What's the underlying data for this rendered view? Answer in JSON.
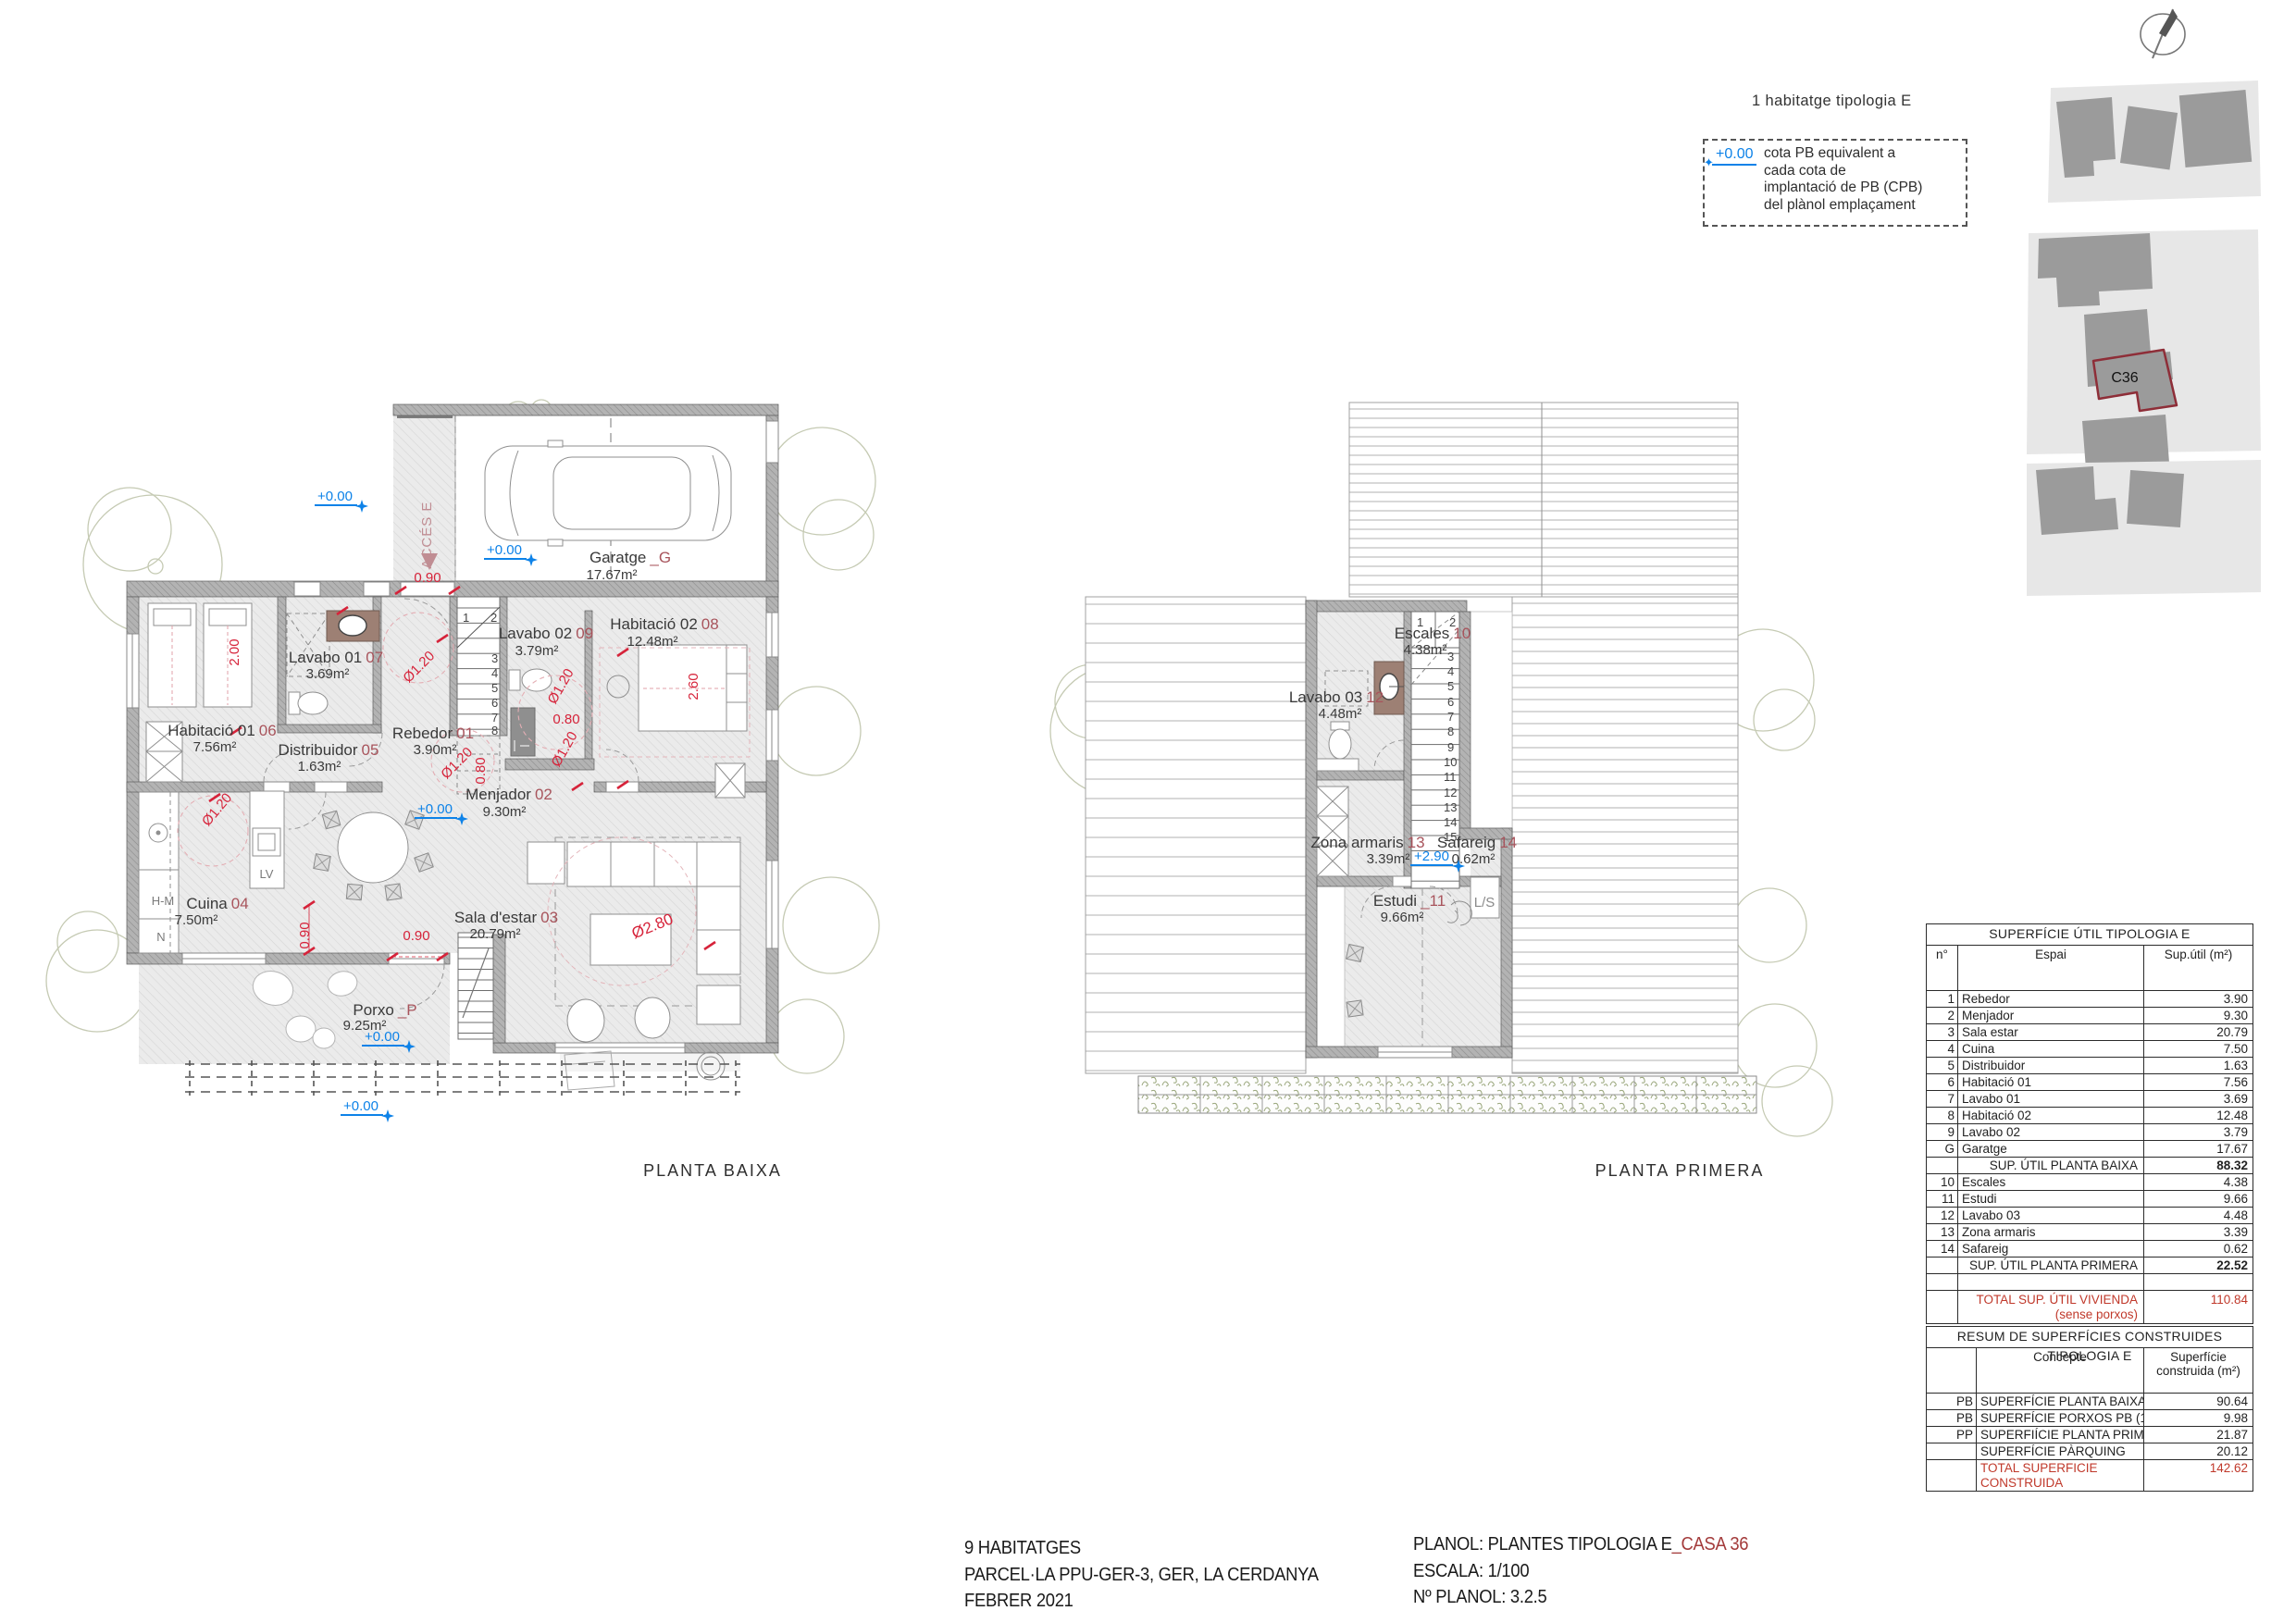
{
  "header": {
    "note": "1 habitatge tipologia E"
  },
  "legend": {
    "cota": "+0.00",
    "lines": [
      "cota PB equivalent a",
      "cada cota de",
      "implantació de PB (CPB)",
      "del plànol emplaçament"
    ]
  },
  "site_map": {
    "parcel_label": "C36"
  },
  "plans": {
    "pb": {
      "caption": "PLANTA BAIXA",
      "access_label": "ACCÉS E",
      "rooms": [
        {
          "name": "Garatge",
          "code": "_G",
          "area": "17.67m²"
        },
        {
          "name": "Lavabo 02",
          "code": "09",
          "area": "3.79m²"
        },
        {
          "name": "Habitació 02",
          "code": "08",
          "area": "12.48m²"
        },
        {
          "name": "Lavabo 01",
          "code": "07",
          "area": "3.69m²"
        },
        {
          "name": "Habitació 01",
          "code": "06",
          "area": "7.56m²"
        },
        {
          "name": "Distribuidor",
          "code": "05",
          "area": "1.63m²"
        },
        {
          "name": "Rebedor",
          "code": "01",
          "area": "3.90m²"
        },
        {
          "name": "Menjador",
          "code": "02",
          "area": "9.30m²"
        },
        {
          "name": "Cuina",
          "code": "04",
          "area": "7.50m²"
        },
        {
          "name": "Sala d'estar",
          "code": "03",
          "area": "20.79m²"
        },
        {
          "name": "Porxo",
          "code": "_P",
          "area": "9.25m²"
        }
      ],
      "dims": [
        "0.90",
        "2.00",
        "Ø1.20",
        "Ø1.20",
        "0.80",
        "Ø1.20",
        "Ø1.20",
        "0.80",
        "2.60",
        "Ø1.20",
        "0.90",
        "0.90",
        "Ø2.80"
      ],
      "cotas": [
        "+0.00",
        "+0.00",
        "+0.00",
        "+0.00",
        "+0.00"
      ],
      "appliances": {
        "lv": "LV",
        "hm": "H-M",
        "n": "N"
      },
      "stair_numbers": [
        "1",
        "2",
        "3",
        "4",
        "5",
        "6",
        "7",
        "8"
      ]
    },
    "pp": {
      "caption": "PLANTA PRIMERA",
      "cota": "+2.90",
      "ls": "L/S",
      "rooms": [
        {
          "name": "Escales",
          "code": "10",
          "area": "4.38m²"
        },
        {
          "name": "Lavabo 03",
          "code": "12",
          "area": "4.48m²"
        },
        {
          "name": "Zona armaris",
          "code": "13",
          "area": "3.39m²"
        },
        {
          "name": "Safareig",
          "code": "14",
          "area": "0.62m²"
        },
        {
          "name": "Estudi",
          "code": "_11",
          "area": "9.66m²"
        }
      ],
      "stair_numbers": [
        "1",
        "2",
        "3",
        "4",
        "5",
        "6",
        "7",
        "8",
        "9",
        "10",
        "11",
        "12",
        "13",
        "14",
        "15"
      ]
    }
  },
  "tables": {
    "util": {
      "title": "SUPERFÍCIE ÚTIL TIPOLOGIA E",
      "col_no": "n°",
      "col_espai": "Espai",
      "col_sup": "Sup.útil (m²)",
      "rows": [
        {
          "no": "1",
          "espai": "Rebedor",
          "sup": "3.90"
        },
        {
          "no": "2",
          "espai": "Menjador",
          "sup": "9.30"
        },
        {
          "no": "3",
          "espai": "Sala estar",
          "sup": "20.79"
        },
        {
          "no": "4",
          "espai": "Cuina",
          "sup": "7.50"
        },
        {
          "no": "5",
          "espai": "Distribuidor",
          "sup": "1.63"
        },
        {
          "no": "6",
          "espai": "Habitació 01",
          "sup": "7.56"
        },
        {
          "no": "7",
          "espai": "Lavabo 01",
          "sup": "3.69"
        },
        {
          "no": "8",
          "espai": "Habitació 02",
          "sup": "12.48"
        },
        {
          "no": "9",
          "espai": "Lavabo 02",
          "sup": "3.79"
        },
        {
          "no": "G",
          "espai": "Garatge",
          "sup": "17.67"
        }
      ],
      "subtotal_pb": {
        "label": "SUP. ÚTIL PLANTA BAIXA",
        "value": "88.32"
      },
      "rows2": [
        {
          "no": "10",
          "espai": "Escales",
          "sup": "4.38"
        },
        {
          "no": "11",
          "espai": "Estudi",
          "sup": "9.66"
        },
        {
          "no": "12",
          "espai": "Lavabo 03",
          "sup": "4.48"
        },
        {
          "no": "13",
          "espai": "Zona armaris",
          "sup": "3.39"
        },
        {
          "no": "14",
          "espai": "Safareig",
          "sup": "0.62"
        }
      ],
      "subtotal_pp": {
        "label": "SUP. ÚTIL PLANTA PRIMERA",
        "value": "22.52"
      },
      "total": {
        "label1": "TOTAL SUP.  ÚTIL VIVIENDA",
        "label2": "(sense porxos)",
        "value": "110.84"
      }
    },
    "resum": {
      "title": "RESUM DE SUPERFÍCIES CONSTRUIDES TIPOLOGIA E",
      "col_concepte": "Concepte",
      "col_sup1": "Superfície",
      "col_sup2": "construida (m²)",
      "rows": [
        {
          "code": "PB",
          "concepte": "SUPERFÍCIE PLANTA BAIXA",
          "value": "90.64"
        },
        {
          "code": "PB",
          "concepte": "SUPERFÍCIE PORXOS PB (100%)",
          "value": "9.98"
        },
        {
          "code": "PP",
          "concepte": "SUPERFIÍCIE PLANTA PRIMERA",
          "value": "21.87"
        },
        {
          "code": "",
          "concepte": "SUPERFÍCIE PÀRQUING",
          "value": "20.12"
        }
      ],
      "total": {
        "label1": "TOTAL SUPERFICIE",
        "label2": "CONSTRUIDA",
        "value": "142.62"
      }
    }
  },
  "titleblock": {
    "left1": "9 HABITATGES",
    "left2": "PARCEL·LA PPU-GER-3, GER, LA CERDANYA",
    "left3": "FEBRER 2021",
    "plan_label": "PLANOL: PLANTES TIPOLOGIA E",
    "plan_highlight": "_CASA 36",
    "escala": "ESCALA: 1/100",
    "num_planol": "Nº PLANOL: 3.2.5"
  }
}
